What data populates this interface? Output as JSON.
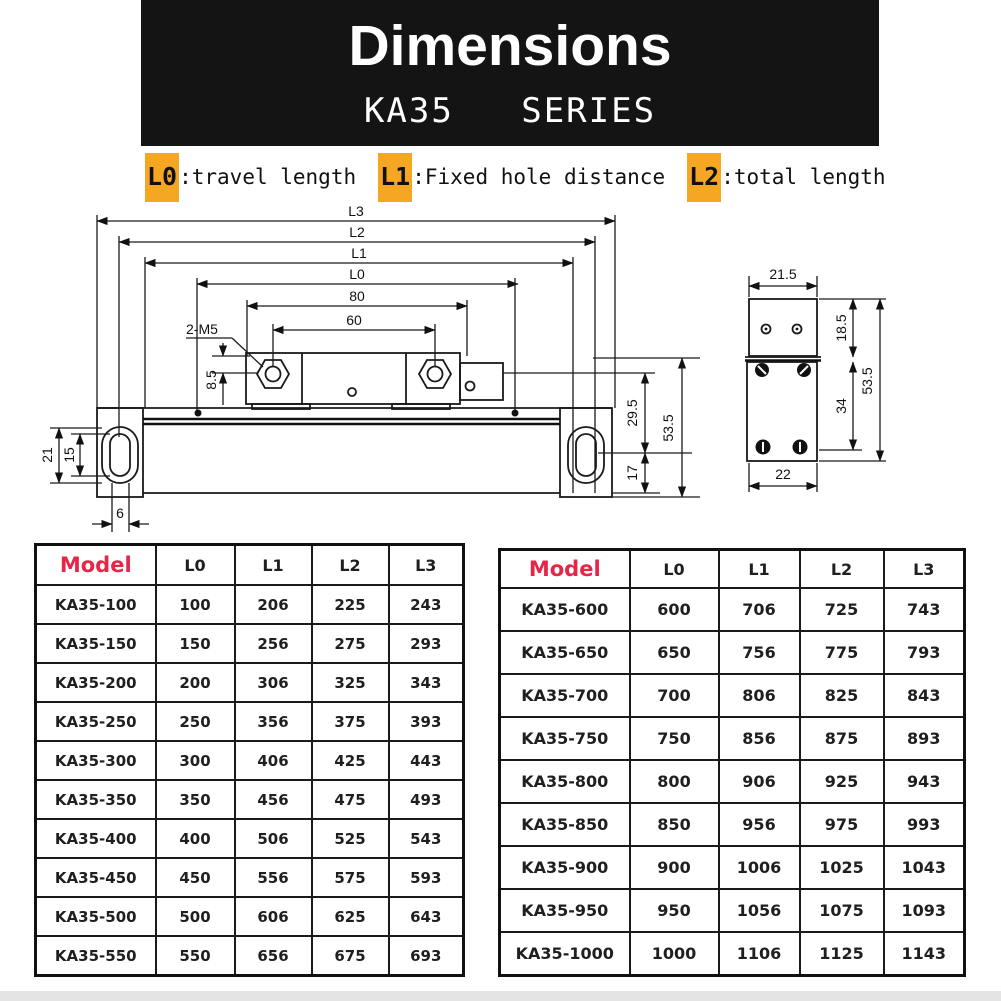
{
  "header": {
    "title": "Dimensions",
    "series": "KA35   SERIES"
  },
  "legend": {
    "items": [
      {
        "key": "L0",
        "desc": ":travel length"
      },
      {
        "key": "L1",
        "desc": ":Fixed hole distance"
      },
      {
        "key": "L2",
        "desc": ":total length"
      }
    ],
    "highlight_color": "#F5A623"
  },
  "drawing": {
    "front_view_labels": {
      "l3": "L3",
      "l2": "L2",
      "l1": "L1",
      "l0": "L0",
      "d80": "80",
      "d60": "60",
      "m5": "2-M5",
      "d8_5": "8.5",
      "d21": "21",
      "d15": "15",
      "d6": "6",
      "d29_5": "29.5",
      "d17": "17",
      "d53_5": "53.5"
    },
    "side_view_labels": {
      "d21_5": "21.5",
      "d18_5": "18.5",
      "d34": "34",
      "d53_5": "53.5",
      "d22": "22"
    }
  },
  "tables": {
    "left": {
      "headers": [
        "Model",
        "L0",
        "L1",
        "L2",
        "L3"
      ],
      "rows": [
        [
          "KA35-100",
          "100",
          "206",
          "225",
          "243"
        ],
        [
          "KA35-150",
          "150",
          "256",
          "275",
          "293"
        ],
        [
          "KA35-200",
          "200",
          "306",
          "325",
          "343"
        ],
        [
          "KA35-250",
          "250",
          "356",
          "375",
          "393"
        ],
        [
          "KA35-300",
          "300",
          "406",
          "425",
          "443"
        ],
        [
          "KA35-350",
          "350",
          "456",
          "475",
          "493"
        ],
        [
          "KA35-400",
          "400",
          "506",
          "525",
          "543"
        ],
        [
          "KA35-450",
          "450",
          "556",
          "575",
          "593"
        ],
        [
          "KA35-500",
          "500",
          "606",
          "625",
          "643"
        ],
        [
          "KA35-550",
          "550",
          "656",
          "675",
          "693"
        ]
      ]
    },
    "right": {
      "headers": [
        "Model",
        "L0",
        "L1",
        "L2",
        "L3"
      ],
      "rows": [
        [
          "KA35-600",
          "600",
          "706",
          "725",
          "743"
        ],
        [
          "KA35-650",
          "650",
          "756",
          "775",
          "793"
        ],
        [
          "KA35-700",
          "700",
          "806",
          "825",
          "843"
        ],
        [
          "KA35-750",
          "750",
          "856",
          "875",
          "893"
        ],
        [
          "KA35-800",
          "800",
          "906",
          "925",
          "943"
        ],
        [
          "KA35-850",
          "850",
          "956",
          "975",
          "993"
        ],
        [
          "KA35-900",
          "900",
          "1006",
          "1025",
          "1043"
        ],
        [
          "KA35-950",
          "950",
          "1056",
          "1075",
          "1093"
        ],
        [
          "KA35-1000",
          "1000",
          "1106",
          "1125",
          "1143"
        ]
      ]
    }
  },
  "colors": {
    "header_bg": "#141414",
    "model_red": "#e62547",
    "line": "#1a1a1a"
  }
}
